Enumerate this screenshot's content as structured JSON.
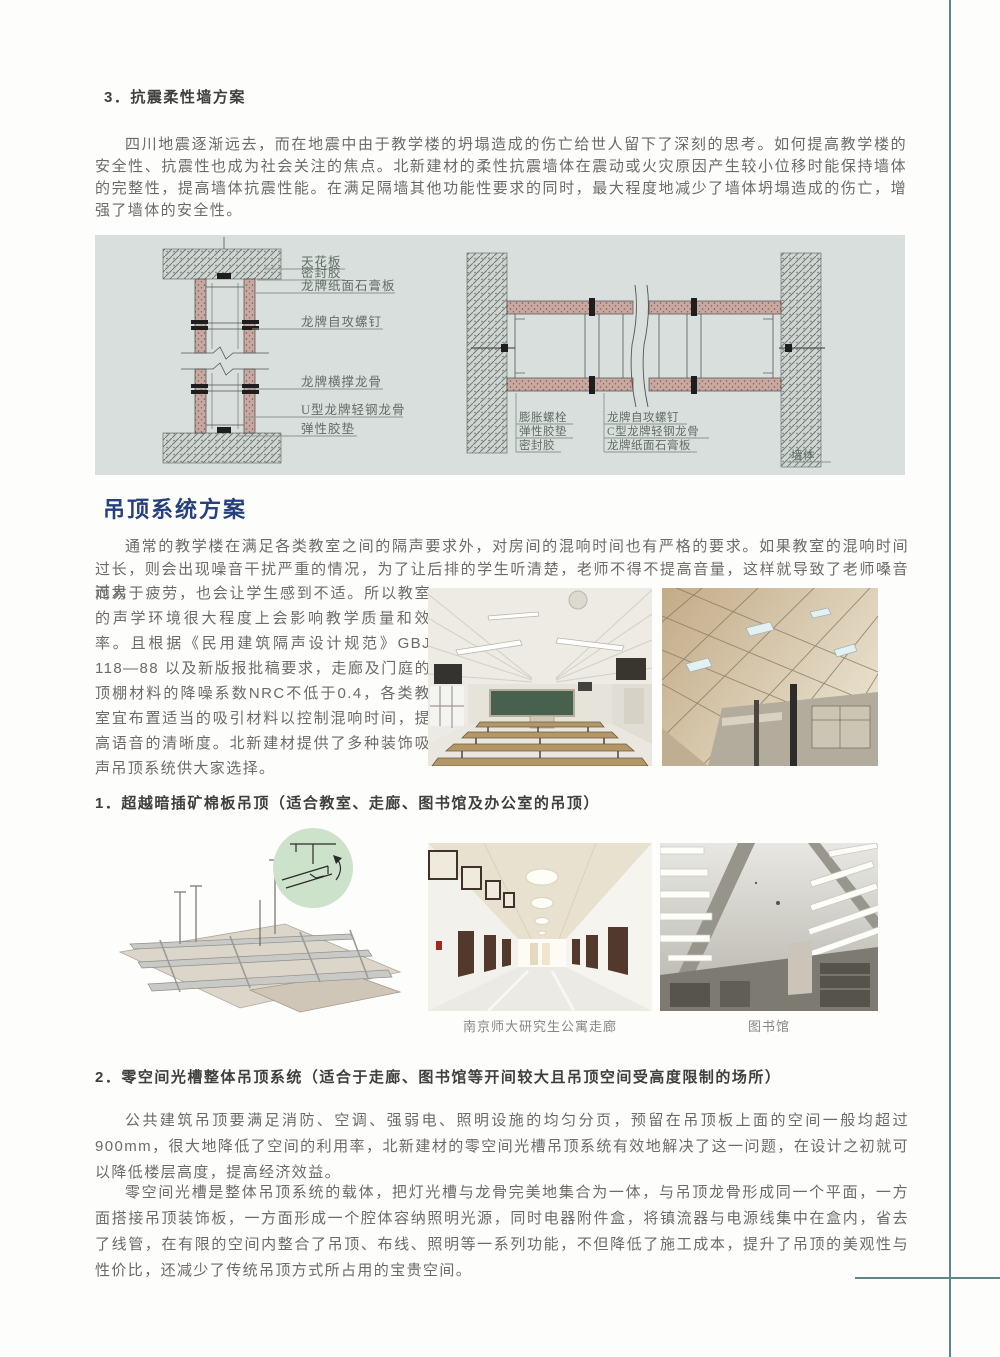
{
  "page": {
    "accent_teal": "#5f8585",
    "panel_bg": "#d8dfdc",
    "heading_navy": "#25407d",
    "body_text_color": "#6e6a66"
  },
  "wall_section": {
    "heading": "3．抗震柔性墙方案",
    "paragraph": "四川地震逐渐远去，而在地震中由于教学楼的坍塌造成的伤亡给世人留下了深刻的思考。如何提高教学楼的安全性、抗震性也成为社会关注的焦点。北新建材的柔性抗震墙体在震动或火灾原因产生较小位移时能保持墙体的完整性，提高墙体抗震性能。在满足隔墙其他功能性要求的同时，最大程度地减少了墙体坍塌造成的伤亡，增强了墙体的安全性。",
    "diagram_left_labels": [
      "天花板",
      "密封胶",
      "龙牌纸面石膏板",
      "龙牌自攻螺钉",
      "龙牌横撑龙骨",
      "U型龙牌轻钢龙骨",
      "弹性胶垫"
    ],
    "diagram_right_labels_col1": [
      "膨胀螺栓",
      "弹性胶垫",
      "密封胶"
    ],
    "diagram_right_labels_col2": [
      "龙牌自攻螺钉",
      "C型龙牌轻钢龙骨",
      "龙牌纸面石膏板"
    ],
    "diagram_right_label_wall": "墙体"
  },
  "ceiling_section": {
    "heading": "吊顶系统方案",
    "paragraph_part1": "通常的教学楼在满足各类教室之间的隔声要求外，对房间的混响时间也有严格的要求。如果教室的混响时间过长，则会出现噪音干扰严重的情况，为了让后排的学生听清楚，老师不得不提高音量，这样就导致了老师嗓音过大",
    "paragraph_part2": "而易于疲劳，也会让学生感到不适。所以教室的声学环境很大程度上会影响教学质量和效率。且根据《民用建筑隔声设计规范》GBJ 118—88 以及新版报批稿要求，走廊及门庭的顶棚材料的降噪系数NRC不低于0.4，各类教室宜布置适当的吸引材料以控制混响时间，提高语音的清晰度。北新建材提供了多种装饰吸声吊顶系统供大家选择。"
  },
  "sub1": {
    "heading": "1．超越暗插矿棉板吊顶（适合教室、走廊、图书馆及办公室的吊顶）",
    "caption_corridor": "南京师大研究生公寓走廊",
    "caption_library": "图书馆"
  },
  "sub2": {
    "heading": "2．零空间光槽整体吊顶系统（适合于走廊、图书馆等开间较大且吊顶空间受高度限制的场所）",
    "paragraph1": "公共建筑吊顶要满足消防、空调、强弱电、照明设施的均匀分页，预留在吊顶板上面的空间一般均超过900mm，很大地降低了空间的利用率，北新建材的零空间光槽吊顶系统有效地解决了这一问题，在设计之初就可以降低楼层高度，提高经济效益。",
    "paragraph2": "零空间光槽是整体吊顶系统的载体，把灯光槽与龙骨完美地集合为一体，与吊顶龙骨形成同一个平面，一方面搭接吊顶装饰板，一方面形成一个腔体容纳照明光源，同时电器附件盒，将镇流器与电源线集中在盒内，省去了线管，在有限的空间内整合了吊顶、布线、照明等一系列功能，不但降低了施工成本，提升了吊顶的美观性与性价比，还减少了传统吊顶方式所占用的宝贵空间。"
  }
}
